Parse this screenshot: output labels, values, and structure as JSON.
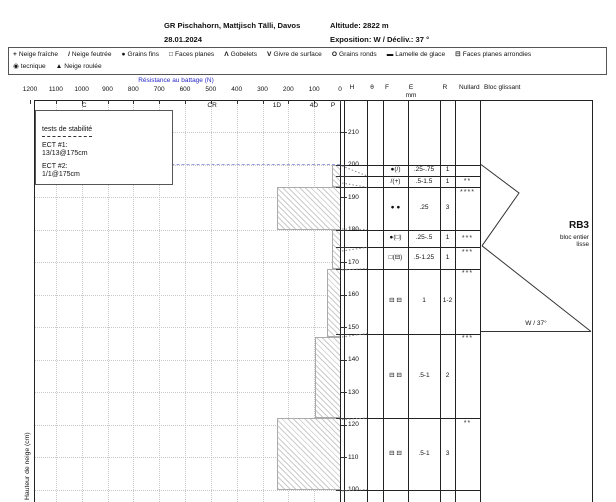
{
  "header": {
    "title": "GR Pischahorn, Mattjisch Tälli, Davos",
    "date": "28.01.2024",
    "altitude": "Altitude: 2822 m",
    "exposition": "Exposition: W / Décliv.: 37 °"
  },
  "legend": {
    "rows": [
      [
        {
          "sym": "+",
          "label": "Neige fraîche"
        },
        {
          "sym": "/",
          "label": "Neige feutrée"
        },
        {
          "sym": "●",
          "label": "Grains fins"
        },
        {
          "sym": "□",
          "label": "Faces planes"
        },
        {
          "sym": "Λ",
          "label": "Gobelets"
        },
        {
          "sym": "V",
          "label": "Givre de surface"
        },
        {
          "sym": "O",
          "label": "Grains ronds"
        },
        {
          "sym": "▬",
          "label": "Lamelle de glace"
        },
        {
          "sym": "⊟",
          "label": "Faces planes arrondies"
        }
      ],
      [
        {
          "sym": "◉",
          "label": "tecnique"
        },
        {
          "sym": "▲",
          "label": "Neige roulée"
        }
      ]
    ]
  },
  "stability": {
    "title": "tests de stabilité",
    "tests": [
      {
        "name": "ECT #1:",
        "result": "13/13@175cm"
      },
      {
        "name": "ECT #2:",
        "result": "1/1@175cm"
      }
    ]
  },
  "table": {
    "headers": {
      "h": "H",
      "theta": "θ",
      "f": "F",
      "e": "E",
      "e_unit": "mm",
      "r": "R",
      "nullard": "Nullard",
      "bloc": "Bloc glissant"
    }
  },
  "bloc_glissant": {
    "result": "RB3",
    "desc_line1": "bloc entier",
    "desc_line2": "lisse",
    "slope_label": "W / 37°"
  },
  "chart_data": {
    "type": "bar",
    "title": "Résistance au battage (N)",
    "ylabel": "Hauteur de neige (cm)",
    "snow_surface_cm": 200,
    "x_axis": {
      "ticks": [
        1200,
        1100,
        1000,
        900,
        800,
        700,
        600,
        500,
        400,
        300,
        200,
        100,
        0
      ],
      "reversed": true,
      "unit": "N"
    },
    "y_axis": {
      "ticks": [
        210,
        200,
        190,
        180,
        170,
        160,
        150,
        140,
        130,
        120,
        110,
        100
      ],
      "unit": "cm"
    },
    "hand_hardness_marks": [
      {
        "text": "C",
        "N": 990
      },
      {
        "text": "CR",
        "N": 495
      },
      {
        "text": "1D",
        "N": 244
      },
      {
        "text": "4D",
        "N": 101
      },
      {
        "text": "P",
        "N": 27
      }
    ],
    "resistance_profile": [
      {
        "from_cm": 200,
        "to_cm": 193,
        "N": 30
      },
      {
        "from_cm": 193,
        "to_cm": 180,
        "N": 245
      },
      {
        "from_cm": 180,
        "to_cm": 168,
        "N": 30
      },
      {
        "from_cm": 168,
        "to_cm": 147,
        "N": 50
      },
      {
        "from_cm": 147,
        "to_cm": 122,
        "N": 95
      },
      {
        "from_cm": 122,
        "to_cm": 100,
        "N": 245
      }
    ],
    "layers": [
      {
        "from_cm": 200,
        "to_cm": 196.5,
        "F": "●(/)",
        "E_mm": ".25-.75",
        "R": "1",
        "stars": "",
        "stars_pos": "top"
      },
      {
        "from_cm": 196.5,
        "to_cm": 193,
        "F": "/(+)",
        "E_mm": ".5-1.5",
        "R": "1",
        "stars": "**",
        "stars_pos": "center"
      },
      {
        "from_cm": 193,
        "to_cm": 180,
        "F": "● ●",
        "E_mm": ".25",
        "R": "3",
        "stars": "****",
        "stars_pos": "top"
      },
      {
        "from_cm": 180,
        "to_cm": 174.5,
        "F": "●(□)",
        "E_mm": ".25-.5",
        "R": "1",
        "stars": "***",
        "stars_pos": "center"
      },
      {
        "from_cm": 174.5,
        "to_cm": 168,
        "F": "□(⊟)",
        "E_mm": ".5-1.25",
        "R": "1",
        "stars": "***",
        "stars_pos": "top"
      },
      {
        "from_cm": 168,
        "to_cm": 148,
        "F": "⊟ ⊟",
        "E_mm": "1",
        "R": "1-2",
        "stars": "***",
        "stars_pos": "top"
      },
      {
        "from_cm": 148,
        "to_cm": 122,
        "F": "⊟ ⊟",
        "E_mm": ".5-1",
        "R": "2",
        "stars": "***",
        "stars_pos": "top"
      },
      {
        "from_cm": 122,
        "to_cm": 100,
        "F": "⊟ ⊟",
        "E_mm": ".5-1",
        "R": "3",
        "stars": "**",
        "stars_pos": "top"
      }
    ]
  }
}
